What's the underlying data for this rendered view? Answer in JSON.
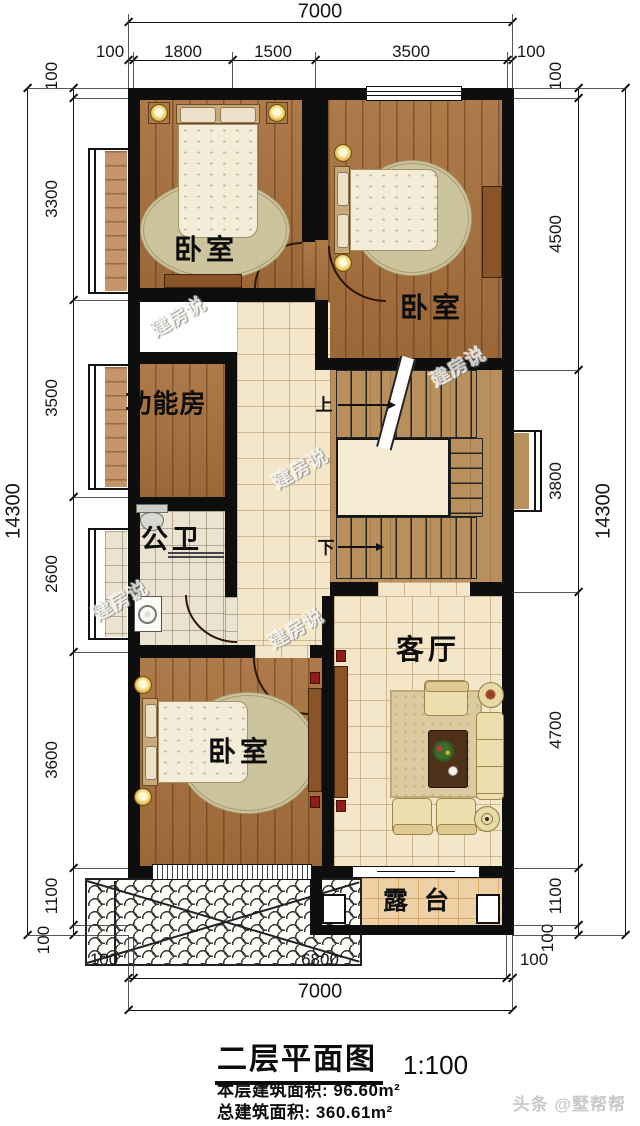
{
  "plan": {
    "title": "二层平面图",
    "scale": "1:100",
    "area1_label": "本层建筑面积:",
    "area1_value": "96.60m²",
    "area2_label": "总建筑面积:",
    "area2_value": "360.61m²",
    "footer_watermark": "头条 @墅帮帮",
    "plan_watermark": "建房说"
  },
  "rooms": {
    "bedroom_top_left": "卧室",
    "bedroom_top_right": "卧室",
    "function_room": "功能房",
    "bathroom": "公卫",
    "bedroom_bottom_left": "卧室",
    "living_room": "客厅",
    "terrace": "露台"
  },
  "stairs": {
    "up": "上",
    "down": "下"
  },
  "dims": {
    "top": {
      "total": "7000",
      "segs": [
        "100",
        "1800",
        "1500",
        "3500",
        "100"
      ]
    },
    "bottom": {
      "total": "7000",
      "segs": [
        "100",
        "6800",
        "100"
      ]
    },
    "left": {
      "total": "14300",
      "segs": [
        "100",
        "3300",
        "3500",
        "2600",
        "3600",
        "1100",
        "100"
      ]
    },
    "right": {
      "total": "14300",
      "segs": [
        "100",
        "4500",
        "3800",
        "4700",
        "1100",
        "100"
      ]
    }
  },
  "colors": {
    "wall": "#0e0e0e",
    "wood_floor": "#a8703c",
    "bay_wood": "#c59468",
    "tile_floor": "#f4e6c8",
    "bath_tile": "#ebe2d0",
    "stair_floor": "#b98f5c",
    "terrace_tile": "#edd0a6"
  }
}
